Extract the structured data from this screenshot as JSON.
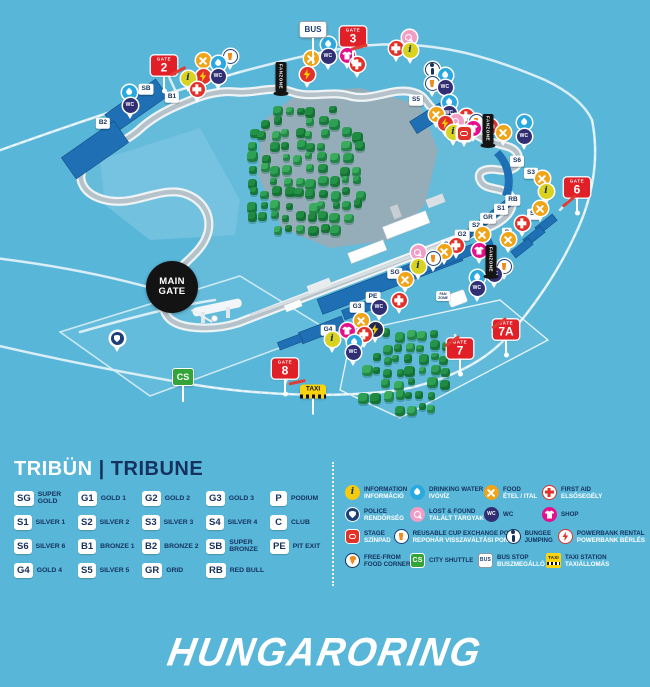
{
  "colors": {
    "background": "#58b6d8",
    "navy": "#15315e",
    "white": "#ffffff",
    "gate_red": "#e01f26",
    "stand_blue": "#1e6fb4",
    "tree_green": "#2d9c50",
    "track_grey": "#b5c2c9"
  },
  "map": {
    "gates": [
      {
        "label": "GATE",
        "number": "2",
        "x": 164,
        "y": 93
      },
      {
        "label": "GATE",
        "number": "3",
        "x": 353,
        "y": 64
      },
      {
        "label": "GATE",
        "number": "6",
        "x": 577,
        "y": 215
      },
      {
        "label": "GATE",
        "number": "7",
        "x": 460,
        "y": 376
      },
      {
        "label": "GATE",
        "number": "7A",
        "x": 506,
        "y": 357
      },
      {
        "label": "GATE",
        "number": "8",
        "x": 285,
        "y": 396
      }
    ],
    "bus_sign": {
      "text": "BUS",
      "x": 313,
      "y": 64
    },
    "cs_sign": {
      "text": "CS",
      "x": 183,
      "y": 402
    },
    "taxi_sign": {
      "text": "TAXI",
      "x": 313,
      "y": 414
    },
    "main_gate": {
      "line1": "MAIN",
      "line2": "GATE",
      "x": 172,
      "y": 287
    },
    "tent_label": {
      "line1": "FAN",
      "line2": "ZONE",
      "x": 443,
      "y": 296
    },
    "fanzone_flags": [
      {
        "text": "FANZONE",
        "x": 281,
        "y": 96
      },
      {
        "text": "FANZONE",
        "x": 488,
        "y": 148
      },
      {
        "text": "FANZONE",
        "x": 491,
        "y": 279
      }
    ],
    "barriers": [
      {
        "x": 178,
        "y": 71,
        "r": -28
      },
      {
        "x": 359,
        "y": 47,
        "r": -15
      },
      {
        "x": 569,
        "y": 201,
        "r": -40
      },
      {
        "x": 452,
        "y": 341,
        "r": -35
      },
      {
        "x": 499,
        "y": 323,
        "r": -35
      },
      {
        "x": 297,
        "y": 382,
        "r": -12
      }
    ],
    "stand_labels": [
      {
        "code": "SB",
        "x": 146,
        "y": 89
      },
      {
        "code": "B1",
        "x": 172,
        "y": 97
      },
      {
        "code": "B2",
        "x": 103,
        "y": 123
      },
      {
        "code": "S5",
        "x": 416,
        "y": 100
      },
      {
        "code": "S6",
        "x": 517,
        "y": 161
      },
      {
        "code": "S3",
        "x": 531,
        "y": 173
      },
      {
        "code": "RB",
        "x": 513,
        "y": 200
      },
      {
        "code": "S1",
        "x": 501,
        "y": 209
      },
      {
        "code": "GR",
        "x": 488,
        "y": 218
      },
      {
        "code": "S2",
        "x": 476,
        "y": 226
      },
      {
        "code": "G2",
        "x": 462,
        "y": 235
      },
      {
        "code": "G1",
        "x": 448,
        "y": 245
      },
      {
        "code": "S4",
        "x": 534,
        "y": 214
      },
      {
        "code": "C",
        "x": 522,
        "y": 223
      },
      {
        "code": "P",
        "x": 507,
        "y": 233
      },
      {
        "code": "SG",
        "x": 395,
        "y": 273
      },
      {
        "code": "PE",
        "x": 373,
        "y": 297
      },
      {
        "code": "G3",
        "x": 357,
        "y": 307
      },
      {
        "code": "G4",
        "x": 328,
        "y": 330
      }
    ],
    "pins": [
      {
        "type": "food",
        "x": 203,
        "y": 74
      },
      {
        "type": "water",
        "x": 218,
        "y": 77
      },
      {
        "type": "cup",
        "x": 230,
        "y": 70
      },
      {
        "type": "info",
        "x": 188,
        "y": 92
      },
      {
        "type": "powerbank_red",
        "x": 203,
        "y": 90
      },
      {
        "type": "wc",
        "x": 218,
        "y": 90
      },
      {
        "type": "firstaid",
        "x": 197,
        "y": 103
      },
      {
        "type": "water",
        "x": 129,
        "y": 106
      },
      {
        "type": "wc",
        "x": 130,
        "y": 119
      },
      {
        "type": "food",
        "x": 311,
        "y": 72
      },
      {
        "type": "powerbank_red",
        "x": 307,
        "y": 88
      },
      {
        "type": "water",
        "x": 328,
        "y": 58
      },
      {
        "type": "wc",
        "x": 328,
        "y": 70
      },
      {
        "type": "shop",
        "x": 347,
        "y": 69
      },
      {
        "type": "firstaid",
        "x": 357,
        "y": 78
      },
      {
        "type": "lostfound",
        "x": 409,
        "y": 51
      },
      {
        "type": "firstaid",
        "x": 396,
        "y": 62
      },
      {
        "type": "info",
        "x": 410,
        "y": 64
      },
      {
        "type": "bungee",
        "x": 432,
        "y": 83
      },
      {
        "type": "cup",
        "x": 432,
        "y": 97
      },
      {
        "type": "water",
        "x": 445,
        "y": 89
      },
      {
        "type": "wc",
        "x": 445,
        "y": 101
      },
      {
        "type": "water",
        "x": 449,
        "y": 116
      },
      {
        "type": "wc",
        "x": 449,
        "y": 127
      },
      {
        "type": "food",
        "x": 436,
        "y": 128
      },
      {
        "type": "powerbank_red",
        "x": 445,
        "y": 137
      },
      {
        "type": "lostfound",
        "x": 456,
        "y": 135
      },
      {
        "type": "firstaid",
        "x": 466,
        "y": 130
      },
      {
        "type": "cup",
        "x": 476,
        "y": 135
      },
      {
        "type": "shop",
        "x": 473,
        "y": 142
      },
      {
        "type": "firstaid",
        "x": 490,
        "y": 140
      },
      {
        "type": "info",
        "x": 453,
        "y": 146
      },
      {
        "type": "stage",
        "x": 464,
        "y": 147
      },
      {
        "type": "water",
        "x": 524,
        "y": 136
      },
      {
        "type": "wc",
        "x": 524,
        "y": 150
      },
      {
        "type": "food",
        "x": 503,
        "y": 146
      },
      {
        "type": "food",
        "x": 542,
        "y": 192
      },
      {
        "type": "info",
        "x": 546,
        "y": 205
      },
      {
        "type": "food",
        "x": 540,
        "y": 222
      },
      {
        "type": "firstaid",
        "x": 522,
        "y": 237
      },
      {
        "type": "food",
        "x": 482,
        "y": 248
      },
      {
        "type": "food",
        "x": 508,
        "y": 253
      },
      {
        "type": "shop",
        "x": 479,
        "y": 264
      },
      {
        "type": "firstaid",
        "x": 456,
        "y": 259
      },
      {
        "type": "food",
        "x": 444,
        "y": 265
      },
      {
        "type": "cup",
        "x": 433,
        "y": 272
      },
      {
        "type": "lostfound",
        "x": 418,
        "y": 266
      },
      {
        "type": "info",
        "x": 418,
        "y": 280
      },
      {
        "type": "food",
        "x": 405,
        "y": 293
      },
      {
        "type": "cup",
        "x": 504,
        "y": 280
      },
      {
        "type": "wc",
        "x": 494,
        "y": 288
      },
      {
        "type": "water",
        "x": 477,
        "y": 291
      },
      {
        "type": "wc",
        "x": 477,
        "y": 302
      },
      {
        "type": "firstaid",
        "x": 399,
        "y": 314
      },
      {
        "type": "wc",
        "x": 379,
        "y": 321
      },
      {
        "type": "food",
        "x": 361,
        "y": 334
      },
      {
        "type": "shop",
        "x": 347,
        "y": 344
      },
      {
        "type": "powerbank_dark",
        "x": 375,
        "y": 343
      },
      {
        "type": "firstaid",
        "x": 364,
        "y": 348
      },
      {
        "type": "info",
        "x": 332,
        "y": 353
      },
      {
        "type": "water",
        "x": 354,
        "y": 356
      },
      {
        "type": "wc",
        "x": 353,
        "y": 366
      },
      {
        "type": "police",
        "x": 117,
        "y": 352
      }
    ]
  },
  "legend": {
    "tribune": {
      "title_hu": "TRIBÜN",
      "divider": "|",
      "title_en": "TRIBUNE",
      "columns": [
        [
          {
            "code": "SG",
            "label": "SUPER GOLD"
          },
          {
            "code": "S1",
            "label": "SILVER 1"
          },
          {
            "code": "S6",
            "label": "SILVER 6"
          },
          {
            "code": "G4",
            "label": "GOLD 4"
          }
        ],
        [
          {
            "code": "G1",
            "label": "GOLD 1"
          },
          {
            "code": "S2",
            "label": "SILVER 2"
          },
          {
            "code": "B1",
            "label": "BRONZE 1"
          },
          {
            "code": "S5",
            "label": "SILVER 5"
          }
        ],
        [
          {
            "code": "G2",
            "label": "GOLD 2"
          },
          {
            "code": "S3",
            "label": "SILVER 3"
          },
          {
            "code": "B2",
            "label": "BRONZE 2"
          },
          {
            "code": "GR",
            "label": "GRID"
          }
        ],
        [
          {
            "code": "G3",
            "label": "GOLD 3"
          },
          {
            "code": "S4",
            "label": "SILVER 4"
          },
          {
            "code": "SB",
            "label": "SUPER BRONZE"
          },
          {
            "code": "RB",
            "label": "RED BULL"
          }
        ],
        [
          {
            "code": "P",
            "label": "PODIUM"
          },
          {
            "code": "C",
            "label": "CLUB"
          },
          {
            "code": "PE",
            "label": "PIT EXIT"
          }
        ]
      ]
    },
    "services": {
      "rows": [
        [
          {
            "icon": "information",
            "line1": "INFORMATION",
            "line2": "INFORMÁCIÓ",
            "hu": true
          },
          {
            "icon": "water",
            "line1": "DRINKING WATER",
            "line2": "IVÓVÍZ",
            "hu": true
          },
          {
            "icon": "food",
            "line1": "FOOD",
            "line2": "ÉTEL / ITAL",
            "hu": true
          },
          {
            "icon": "firstaid_w",
            "line1": "FIRST AID",
            "line2": "ELSŐSEGÉLY",
            "hu": true
          }
        ],
        [
          {
            "icon": "police",
            "line1": "POLICE",
            "line2": "RENDŐRSÉG",
            "hu": true
          },
          {
            "icon": "lostfound",
            "line1": "LOST & FOUND",
            "line2": "TALÁLT TÁRGYAK",
            "hu": true
          },
          {
            "icon": "wc",
            "line1": "WC"
          },
          {
            "icon": "shop",
            "line1": "SHOP"
          }
        ],
        [
          {
            "icon": "stage",
            "line1": "STAGE",
            "line2": "SZÍNPAD",
            "hu": true
          },
          {
            "icon": "cup",
            "line1": "REUSABLE CUP EXCHANGE POINT",
            "line2": "REPOHÁR VISSZAVÁLTÁSI PONT",
            "hu": true
          },
          {
            "icon": "bungee",
            "line1": "BUNGEE",
            "line2": "JUMPING",
            "hu": false
          },
          {
            "icon": "powerbank_w",
            "line1": "POWERBANK RENTAL",
            "line2": "POWERBANK BÉRLÉS",
            "hu": true
          }
        ],
        [
          {
            "icon": "freefrom",
            "line1": "FREE-FROM",
            "line2": "FOOD CORNER",
            "hu": false
          },
          {
            "icon": "cs",
            "line1": "CITY SHUTTLE"
          },
          {
            "icon": "bus",
            "line1": "BUS STOP",
            "line2": "BUSZMEGÁLLÓ",
            "hu": true
          },
          {
            "icon": "taxi",
            "line1": "TAXI STATION",
            "line2": "TAXIÁLLOMÁS",
            "hu": true
          }
        ]
      ]
    }
  },
  "footer": {
    "logo": "HUNGARORING"
  }
}
